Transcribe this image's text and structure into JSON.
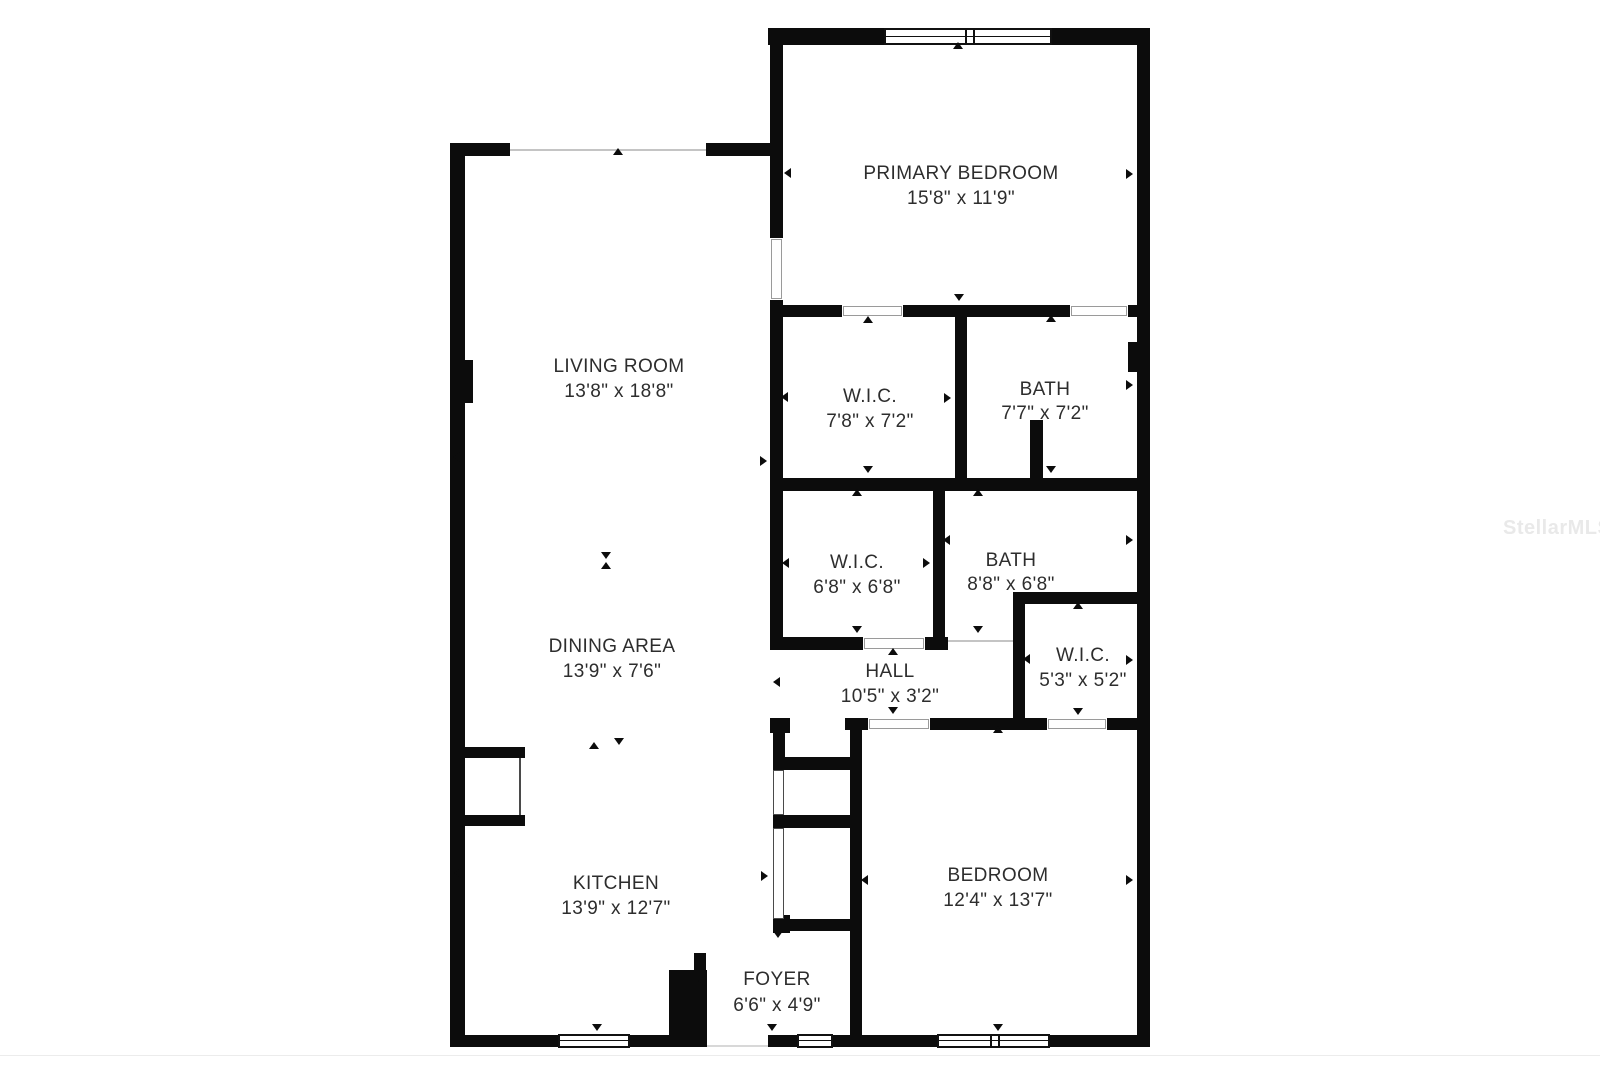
{
  "watermark": "StellarMLS",
  "colors": {
    "wall": "#0c0c0c",
    "text": "#2d2d2d",
    "watermark_gray": "#e9e9e9",
    "background": "#ffffff",
    "opening_line": "#c4c4c4"
  },
  "plan": {
    "rooms": [
      {
        "id": "primary-bedroom",
        "name": "PRIMARY BEDROOM",
        "dims": "15'8\" x 11'9\"",
        "x": 961,
        "name_y": 174,
        "dims_y": 199
      },
      {
        "id": "living-room",
        "name": "LIVING ROOM",
        "dims": "13'8\" x 18'8\"",
        "x": 619,
        "name_y": 367,
        "dims_y": 392
      },
      {
        "id": "wic-primary",
        "name": "W.I.C.",
        "dims": "7'8\" x 7'2\"",
        "x": 870,
        "name_y": 397,
        "dims_y": 422
      },
      {
        "id": "bath-primary",
        "name": "BATH",
        "dims": "7'7\" x 7'2\"",
        "x": 1045,
        "name_y": 390,
        "dims_y": 414
      },
      {
        "id": "wic-2",
        "name": "W.I.C.",
        "dims": "6'8\" x 6'8\"",
        "x": 857,
        "name_y": 563,
        "dims_y": 588
      },
      {
        "id": "bath-2",
        "name": "BATH",
        "dims": "8'8\" x 6'8\"",
        "x": 1011,
        "name_y": 561,
        "dims_y": 585
      },
      {
        "id": "wic-3",
        "name": "W.I.C.",
        "dims": "5'3\" x 5'2\"",
        "x": 1083,
        "name_y": 656,
        "dims_y": 681
      },
      {
        "id": "hall",
        "name": "HALL",
        "dims": "10'5\" x 3'2\"",
        "x": 890,
        "name_y": 672,
        "dims_y": 697
      },
      {
        "id": "dining-area",
        "name": "DINING AREA",
        "dims": "13'9\" x 7'6\"",
        "x": 612,
        "name_y": 647,
        "dims_y": 672
      },
      {
        "id": "kitchen",
        "name": "KITCHEN",
        "dims": "13'9\" x 12'7\"",
        "x": 616,
        "name_y": 884,
        "dims_y": 909
      },
      {
        "id": "foyer",
        "name": "FOYER",
        "dims": "6'6\" x 4'9\"",
        "x": 777,
        "name_y": 980,
        "dims_y": 1006
      },
      {
        "id": "bedroom",
        "name": "BEDROOM",
        "dims": "12'4\" x 13'7\"",
        "x": 998,
        "name_y": 876,
        "dims_y": 901
      }
    ],
    "walls": [
      [
        450,
        143,
        15,
        904
      ],
      [
        463,
        360,
        10,
        43
      ],
      [
        450,
        143,
        60,
        13
      ],
      [
        706,
        143,
        77,
        13
      ],
      [
        770,
        28,
        13,
        210
      ],
      [
        770,
        300,
        13,
        348
      ],
      [
        768,
        28,
        116,
        17
      ],
      [
        1052,
        28,
        98,
        17
      ],
      [
        1137,
        28,
        13,
        1019
      ],
      [
        450,
        1035,
        108,
        12
      ],
      [
        630,
        1035,
        77,
        12
      ],
      [
        768,
        1035,
        29,
        12
      ],
      [
        833,
        1035,
        104,
        12
      ],
      [
        1050,
        1035,
        100,
        12
      ],
      [
        783,
        305,
        59,
        12
      ],
      [
        903,
        305,
        167,
        12
      ],
      [
        1128,
        305,
        22,
        12
      ],
      [
        955,
        317,
        12,
        161
      ],
      [
        1030,
        420,
        13,
        58
      ],
      [
        1128,
        342,
        19,
        30
      ],
      [
        770,
        478,
        380,
        13
      ],
      [
        933,
        491,
        12,
        159
      ],
      [
        770,
        637,
        93,
        13
      ],
      [
        925,
        637,
        23,
        13
      ],
      [
        1013,
        592,
        137,
        12
      ],
      [
        1013,
        592,
        12,
        138
      ],
      [
        770,
        718,
        20,
        15
      ],
      [
        845,
        718,
        23,
        12
      ],
      [
        930,
        718,
        117,
        12
      ],
      [
        1107,
        718,
        43,
        12
      ],
      [
        773,
        718,
        12,
        52
      ],
      [
        773,
        757,
        89,
        13
      ],
      [
        773,
        815,
        89,
        13
      ],
      [
        850,
        718,
        12,
        317
      ],
      [
        773,
        915,
        17,
        18
      ],
      [
        773,
        919,
        80,
        12
      ],
      [
        694,
        953,
        12,
        17
      ],
      [
        669,
        970,
        38,
        77
      ],
      [
        452,
        747,
        73,
        11
      ],
      [
        452,
        815,
        73,
        11
      ]
    ],
    "lines": [
      {
        "x": 510,
        "y": 149,
        "w": 196,
        "h": 2,
        "color": "#c4c4c4"
      },
      {
        "x": 519,
        "y": 758,
        "w": 2,
        "h": 57,
        "color": "#4a4a4a"
      },
      {
        "x": 948,
        "y": 640,
        "w": 65,
        "h": 2,
        "color": "#c4c4c4"
      },
      {
        "x": 707,
        "y": 1045,
        "w": 61,
        "h": 2,
        "color": "#d8d8d8"
      },
      {
        "x": 0,
        "y": 1055,
        "w": 1600,
        "h": 1,
        "color": "#ececec"
      }
    ],
    "doors": [
      {
        "x": 771,
        "y": 239,
        "w": 11,
        "h": 60
      },
      {
        "x": 843,
        "y": 306,
        "w": 59,
        "h": 10
      },
      {
        "x": 1071,
        "y": 306,
        "w": 56,
        "h": 10
      },
      {
        "x": 864,
        "y": 638,
        "w": 60,
        "h": 11
      },
      {
        "x": 869,
        "y": 719,
        "w": 60,
        "h": 10
      },
      {
        "x": 1048,
        "y": 719,
        "w": 58,
        "h": 10
      }
    ],
    "closet_doors": [
      {
        "x": 773,
        "y": 770,
        "w": 11,
        "h": 45
      },
      {
        "x": 773,
        "y": 828,
        "w": 11,
        "h": 91
      }
    ],
    "windows": [
      {
        "x": 884,
        "y": 28,
        "w": 168,
        "h": 17,
        "mullions": [
          79,
          87
        ]
      },
      {
        "x": 558,
        "y": 1034,
        "w": 72,
        "h": 14,
        "mullions": []
      },
      {
        "x": 797,
        "y": 1034,
        "w": 36,
        "h": 14,
        "mullions": []
      },
      {
        "x": 937,
        "y": 1034,
        "w": 113,
        "h": 14,
        "mullions": [
          51,
          59
        ]
      }
    ],
    "markers": [
      {
        "x": 618,
        "y": 153,
        "dir": "up"
      },
      {
        "x": 458,
        "y": 457,
        "dir": "left"
      },
      {
        "x": 765,
        "y": 461,
        "dir": "right"
      },
      {
        "x": 606,
        "y": 557,
        "dir": "down"
      },
      {
        "x": 606,
        "y": 567,
        "dir": "up"
      },
      {
        "x": 594,
        "y": 747,
        "dir": "up"
      },
      {
        "x": 619,
        "y": 743,
        "dir": "down"
      },
      {
        "x": 459,
        "y": 873,
        "dir": "left"
      },
      {
        "x": 766,
        "y": 876,
        "dir": "right"
      },
      {
        "x": 597,
        "y": 1029,
        "dir": "down"
      },
      {
        "x": 703,
        "y": 981,
        "dir": "left"
      },
      {
        "x": 778,
        "y": 936,
        "dir": "down"
      },
      {
        "x": 772,
        "y": 1029,
        "dir": "down"
      },
      {
        "x": 958,
        "y": 47,
        "dir": "up"
      },
      {
        "x": 959,
        "y": 299,
        "dir": "down"
      },
      {
        "x": 789,
        "y": 173,
        "dir": "left"
      },
      {
        "x": 1131,
        "y": 174,
        "dir": "right"
      },
      {
        "x": 868,
        "y": 321,
        "dir": "up"
      },
      {
        "x": 868,
        "y": 471,
        "dir": "down"
      },
      {
        "x": 786,
        "y": 397,
        "dir": "left"
      },
      {
        "x": 949,
        "y": 398,
        "dir": "right"
      },
      {
        "x": 1051,
        "y": 320,
        "dir": "up"
      },
      {
        "x": 1051,
        "y": 471,
        "dir": "down"
      },
      {
        "x": 1131,
        "y": 385,
        "dir": "right"
      },
      {
        "x": 857,
        "y": 494,
        "dir": "up"
      },
      {
        "x": 857,
        "y": 631,
        "dir": "down"
      },
      {
        "x": 787,
        "y": 563,
        "dir": "left"
      },
      {
        "x": 928,
        "y": 563,
        "dir": "right"
      },
      {
        "x": 978,
        "y": 494,
        "dir": "up"
      },
      {
        "x": 978,
        "y": 631,
        "dir": "down"
      },
      {
        "x": 948,
        "y": 540,
        "dir": "left"
      },
      {
        "x": 1131,
        "y": 540,
        "dir": "right"
      },
      {
        "x": 1078,
        "y": 607,
        "dir": "up"
      },
      {
        "x": 1078,
        "y": 713,
        "dir": "down"
      },
      {
        "x": 1028,
        "y": 659,
        "dir": "left"
      },
      {
        "x": 1131,
        "y": 660,
        "dir": "right"
      },
      {
        "x": 893,
        "y": 653,
        "dir": "up"
      },
      {
        "x": 893,
        "y": 712,
        "dir": "down"
      },
      {
        "x": 778,
        "y": 682,
        "dir": "left"
      },
      {
        "x": 998,
        "y": 731,
        "dir": "up"
      },
      {
        "x": 998,
        "y": 1029,
        "dir": "down"
      },
      {
        "x": 866,
        "y": 880,
        "dir": "left"
      },
      {
        "x": 1131,
        "y": 880,
        "dir": "right"
      }
    ],
    "watermark_pos": {
      "x": 1503,
      "y": 517
    }
  }
}
